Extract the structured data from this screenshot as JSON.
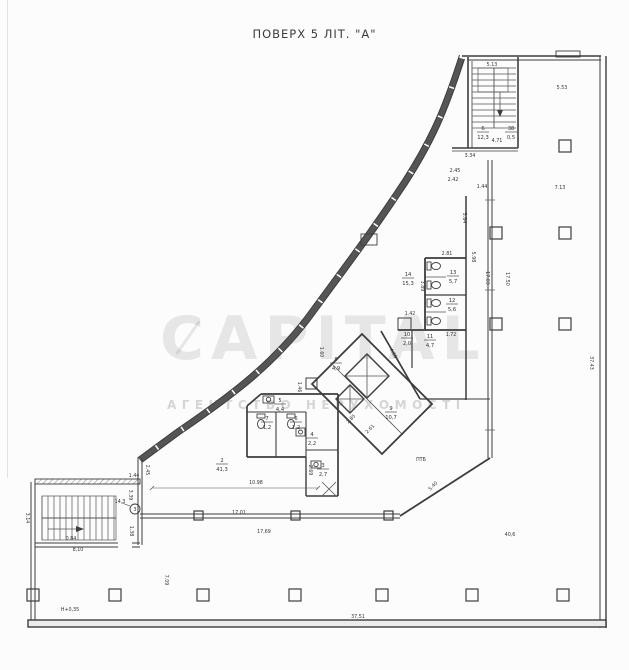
{
  "header": {
    "scale_note": "МАСШТАБ 1:100",
    "title": "ПОВЕРХ 5 ЛІТ. \"А\""
  },
  "watermark": {
    "brand": "CAPITAL",
    "subtitle": "АГЕНТСТВО НЕРУХОМОСТІ"
  },
  "plan": {
    "entry_marker": "3",
    "dimensions": [
      {
        "t": "5.13",
        "x": 492,
        "y": 66,
        "r": 0
      },
      {
        "t": "5.53",
        "x": 562,
        "y": 89,
        "r": 0
      },
      {
        "t": "7.13",
        "x": 560,
        "y": 189,
        "r": 0
      },
      {
        "t": "4.71",
        "x": 497,
        "y": 142,
        "r": 0
      },
      {
        "t": "3.34",
        "x": 470,
        "y": 157,
        "r": 0
      },
      {
        "t": "2.45",
        "x": 455,
        "y": 172,
        "r": 0
      },
      {
        "t": "2.42",
        "x": 453,
        "y": 181,
        "r": 0
      },
      {
        "t": "1.44",
        "x": 482,
        "y": 188,
        "r": 0
      },
      {
        "t": "5.64",
        "x": 463,
        "y": 218,
        "r": 90
      },
      {
        "t": "2.81",
        "x": 447,
        "y": 255,
        "r": 0
      },
      {
        "t": "5.98",
        "x": 472,
        "y": 257,
        "r": 90
      },
      {
        "t": "3.89",
        "x": 421,
        "y": 286,
        "r": 90
      },
      {
        "t": "17.03",
        "x": 486,
        "y": 278,
        "r": 90
      },
      {
        "t": "17.50",
        "x": 506,
        "y": 279,
        "r": 90
      },
      {
        "t": "37.43",
        "x": 590,
        "y": 363,
        "r": 90
      },
      {
        "t": "1.42",
        "x": 410,
        "y": 315,
        "r": 0
      },
      {
        "t": "1.72",
        "x": 451,
        "y": 336,
        "r": 0
      },
      {
        "t": "1.60",
        "x": 320,
        "y": 352,
        "r": 90
      },
      {
        "t": "1.46",
        "x": 298,
        "y": 387,
        "r": 90
      },
      {
        "t": "4.66",
        "x": 392,
        "y": 354,
        "r": 60
      },
      {
        "t": "2.85",
        "x": 352,
        "y": 420,
        "r": -45
      },
      {
        "t": "2.61",
        "x": 371,
        "y": 430,
        "r": -45
      },
      {
        "t": "5.40",
        "x": 434,
        "y": 487,
        "r": -45
      },
      {
        "t": "2.69",
        "x": 309,
        "y": 470,
        "r": 90
      },
      {
        "t": "10.98",
        "x": 256,
        "y": 484,
        "r": 0
      },
      {
        "t": "2.45",
        "x": 146,
        "y": 470,
        "r": 90
      },
      {
        "t": "1.44",
        "x": 134,
        "y": 477,
        "r": 0
      },
      {
        "t": "3.39",
        "x": 129,
        "y": 495,
        "r": 90
      },
      {
        "t": "14,3",
        "x": 120,
        "y": 503,
        "r": 0
      },
      {
        "t": "17.01",
        "x": 239,
        "y": 514,
        "r": 0
      },
      {
        "t": "17,69",
        "x": 264,
        "y": 533,
        "r": 0
      },
      {
        "t": "3.14",
        "x": 26,
        "y": 518,
        "r": 90
      },
      {
        "t": "1.38",
        "x": 130,
        "y": 531,
        "r": 90
      },
      {
        "t": "0.84",
        "x": 71,
        "y": 540,
        "r": 0
      },
      {
        "t": "8,10",
        "x": 78,
        "y": 551,
        "r": 0
      },
      {
        "t": "7.09",
        "x": 165,
        "y": 580,
        "r": 90
      },
      {
        "t": "Н+0,35",
        "x": 70,
        "y": 611,
        "r": 0
      },
      {
        "t": "37,51",
        "x": 358,
        "y": 618,
        "r": 0
      },
      {
        "t": "ПТБ",
        "x": 421,
        "y": 461,
        "r": 0
      },
      {
        "t": "40,6",
        "x": 510,
        "y": 536,
        "r": 0
      }
    ],
    "rooms": [
      {
        "n": "6",
        "a": "12,3",
        "x": 483,
        "y": 130
      },
      {
        "n": "38",
        "a": "0,5",
        "x": 511,
        "y": 130
      },
      {
        "n": "13",
        "a": "5,7",
        "x": 453,
        "y": 274
      },
      {
        "n": "12",
        "a": "5,6",
        "x": 452,
        "y": 302
      },
      {
        "n": "14",
        "a": "15,3",
        "x": 408,
        "y": 276
      },
      {
        "n": "10",
        "a": "2,0",
        "x": 407,
        "y": 336
      },
      {
        "n": "11",
        "a": "4,7",
        "x": 430,
        "y": 338
      },
      {
        "n": "8",
        "a": "4,9",
        "x": 336,
        "y": 361
      },
      {
        "n": "9",
        "a": "10,7",
        "x": 391,
        "y": 410
      },
      {
        "n": "2",
        "a": "41,3",
        "x": 222,
        "y": 462
      },
      {
        "n": "5",
        "a": "4,4",
        "x": 280,
        "y": 402
      },
      {
        "n": "7",
        "a": "1,2",
        "x": 267,
        "y": 420
      },
      {
        "n": "6",
        "a": "1,2",
        "x": 296,
        "y": 420
      },
      {
        "n": "4",
        "a": "2,2",
        "x": 312,
        "y": 436
      },
      {
        "n": "3",
        "a": "2,7",
        "x": 323,
        "y": 467
      }
    ]
  }
}
